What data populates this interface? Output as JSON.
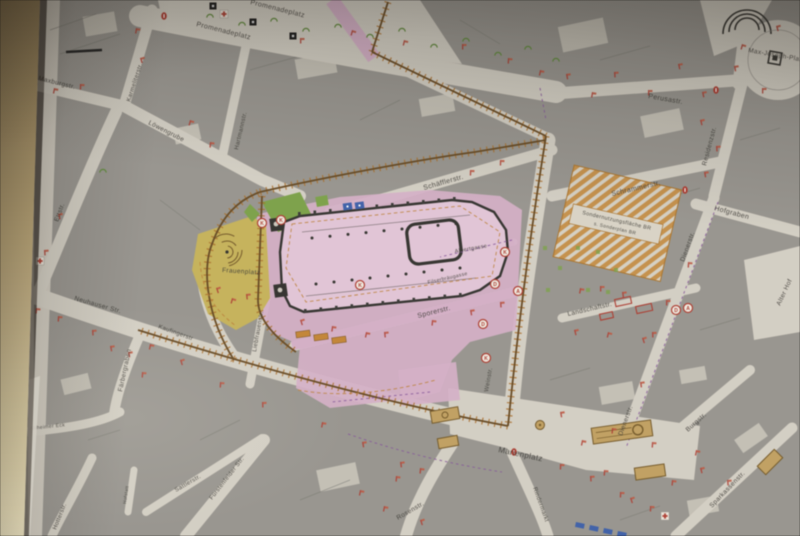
{
  "map": {
    "streets": [
      {
        "label": "Promenadeplatz"
      },
      {
        "label": "Maxburgstr."
      },
      {
        "label": "Karmeliterstr."
      },
      {
        "label": "Löwengrube"
      },
      {
        "label": "Hartmannstr."
      },
      {
        "label": "Ettstr."
      },
      {
        "label": "Neuhauser Str."
      },
      {
        "label": "Kaufingerstr"
      },
      {
        "label": "Liebfrauenstr."
      },
      {
        "label": "Schäfflerstr."
      },
      {
        "label": "Albertgasse"
      },
      {
        "label": "Filserbräugasse"
      },
      {
        "label": "Sporerstr."
      },
      {
        "label": "Weinstr."
      },
      {
        "label": "Schrammerstr."
      },
      {
        "label": "Hofgraben"
      },
      {
        "label": "Dienerstr."
      },
      {
        "label": "Residenzstr."
      },
      {
        "label": "Perusastr."
      },
      {
        "label": "Max-Joseph-Platz"
      },
      {
        "label": "Landschaftstr."
      },
      {
        "label": "Alter Hof"
      },
      {
        "label": "Marienplatz"
      },
      {
        "label": "Rosenstr."
      },
      {
        "label": "Rindermarkt"
      },
      {
        "label": "Sattlerstr."
      },
      {
        "label": "Fürstenfelder Str."
      },
      {
        "label": "Hotterstr."
      },
      {
        "label": "Färbergraben"
      },
      {
        "label": "Altheimer Eck"
      },
      {
        "label": "Hofstatt"
      },
      {
        "label": "Burgstr."
      },
      {
        "label": "Sparkassenstr."
      }
    ],
    "areas": {
      "frauenplatz": "Frauenplatz",
      "special_zone": {
        "line1": "Sondernutzungsfläche BR",
        "line2": "s. Sonderplan BR"
      }
    },
    "badges": {
      "letters": [
        "K",
        "K",
        "K",
        "K",
        "D",
        "A",
        "D",
        "K",
        "D",
        "A"
      ]
    },
    "colors": {
      "wall": "#cdb379",
      "paper": "#d7d1c4",
      "building": "#9a978f",
      "pink": "#dcb0cb",
      "pinklight": "#e8c6da",
      "yellow": "#ccb54c",
      "green": "#79a63c",
      "hatch": "#cf8627",
      "boundary": "#6e4b1d",
      "tick": "#b66f1e",
      "red": "#c0392b",
      "blue": "#3a62b8",
      "purple": "#8d55a6",
      "ink": "#3c3a34",
      "monument": "#c9a257"
    }
  }
}
